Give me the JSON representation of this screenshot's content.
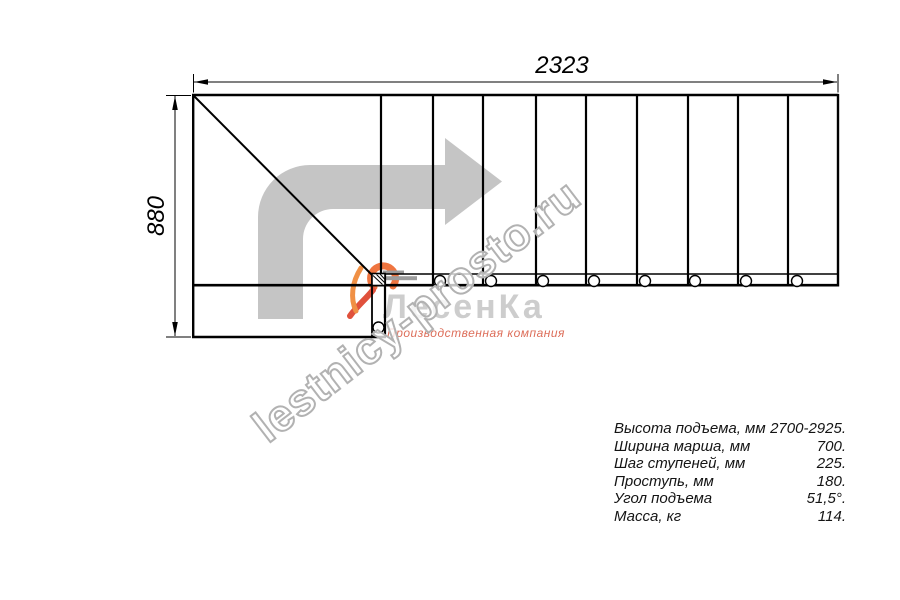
{
  "drawing": {
    "width_dimension": "2323",
    "height_dimension": "880"
  },
  "watermark": {
    "site_text": "lestnicy-prosto.ru",
    "logo_name": "ЛесенКа",
    "logo_tagline": "Производственная компания"
  },
  "specs": {
    "rows": [
      {
        "label": "Высота подъема, мм",
        "value": "2700-2925."
      },
      {
        "label": "Ширина марша, мм",
        "value": "700."
      },
      {
        "label": "Шаг ступеней, мм",
        "value": "225."
      },
      {
        "label": "Проступь, мм",
        "value": "180."
      },
      {
        "label": "Угол подъема",
        "value": "51,5°."
      },
      {
        "label": "Масса, кг",
        "value": "114."
      }
    ]
  },
  "colors": {
    "line": "#000000",
    "arrow_gray": "#c5c5c5",
    "watermark_gray": "#b2b2b2",
    "logo_gray": "#cdcdcd",
    "accent_orange": "#ef7540",
    "accent_red": "#e0513c",
    "tagline_salmon": "#dd6e5a"
  }
}
